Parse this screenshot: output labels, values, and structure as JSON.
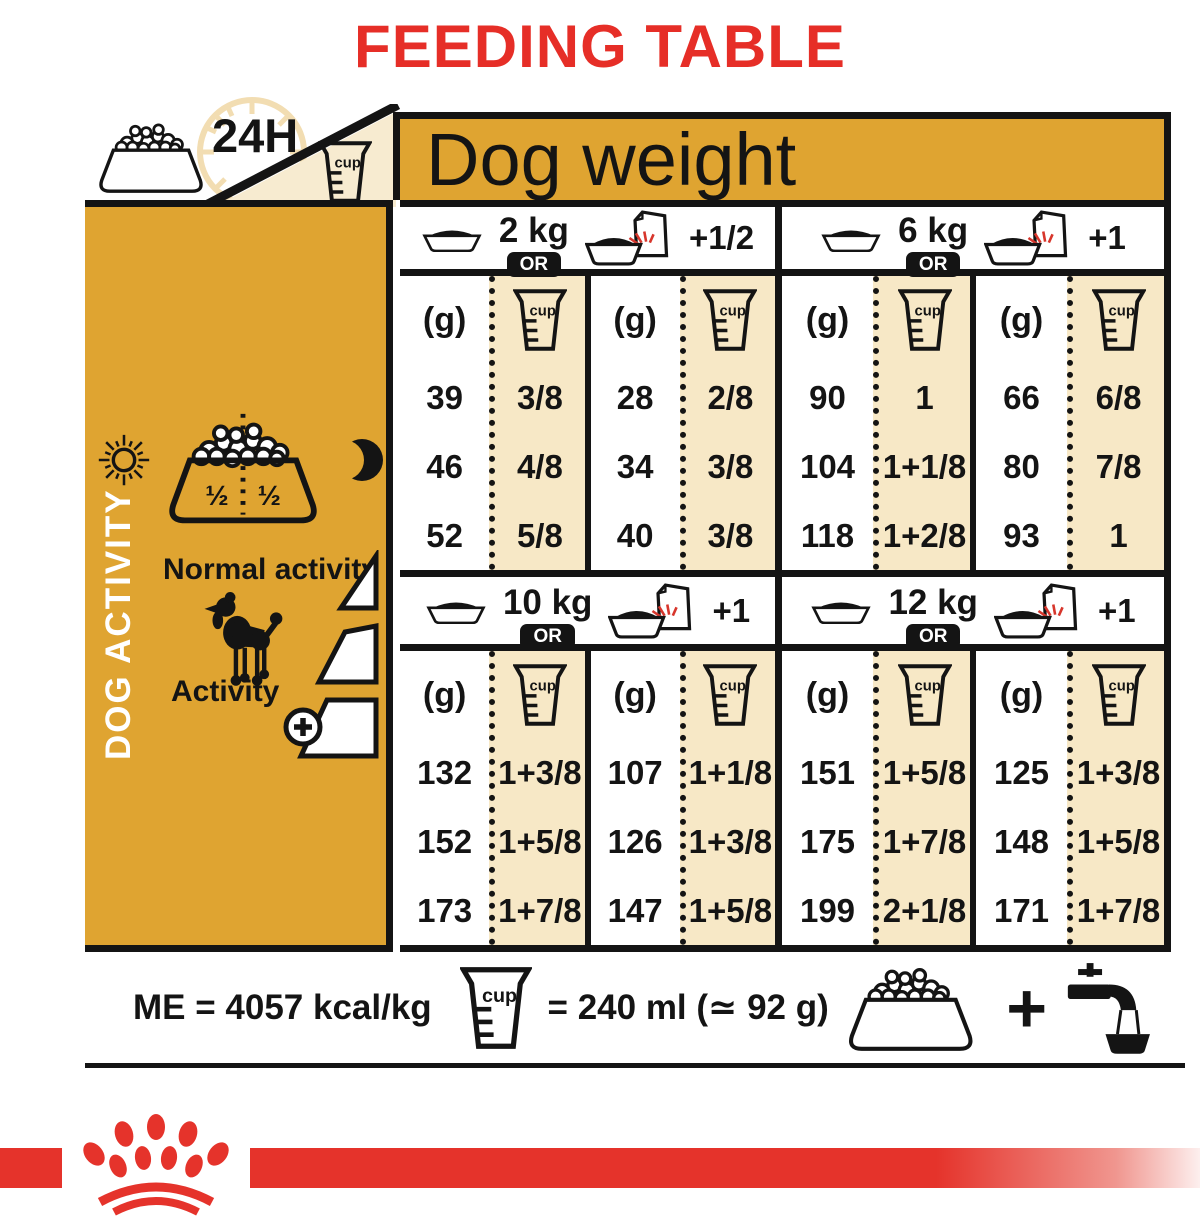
{
  "title": "FEEDING TABLE",
  "colors": {
    "red": "#e62e27",
    "gold": "#dfa431",
    "beige": "#f7e8c6",
    "ink": "#141414"
  },
  "corner": {
    "duration": "24H"
  },
  "dog_weight_header": "Dog weight",
  "labels": {
    "grams": "(g)",
    "cup": "cup",
    "or": "OR"
  },
  "sidebar": {
    "vertical_label": "DOG ACTIVITY",
    "bowl_half_left": "½",
    "bowl_half_right": "½",
    "normal_activity": "Normal activity",
    "activity": "Activity"
  },
  "groups": [
    {
      "weight": "2 kg",
      "extra": "+1/2",
      "cols": [
        {
          "g": [
            "39",
            "46",
            "52"
          ],
          "cup": [
            "3/8",
            "4/8",
            "5/8"
          ]
        },
        {
          "g": [
            "28",
            "34",
            "40"
          ],
          "cup": [
            "2/8",
            "3/8",
            "3/8"
          ]
        }
      ]
    },
    {
      "weight": "6 kg",
      "extra": "+1",
      "cols": [
        {
          "g": [
            "90",
            "104",
            "118"
          ],
          "cup": [
            "1",
            "1+1/8",
            "1+2/8"
          ]
        },
        {
          "g": [
            "66",
            "80",
            "93"
          ],
          "cup": [
            "6/8",
            "7/8",
            "1"
          ]
        }
      ]
    },
    {
      "weight": "10 kg",
      "extra": "+1",
      "cols": [
        {
          "g": [
            "132",
            "152",
            "173"
          ],
          "cup": [
            "1+3/8",
            "1+5/8",
            "1+7/8"
          ]
        },
        {
          "g": [
            "107",
            "126",
            "147"
          ],
          "cup": [
            "1+1/8",
            "1+3/8",
            "1+5/8"
          ]
        }
      ]
    },
    {
      "weight": "12 kg",
      "extra": "+1",
      "cols": [
        {
          "g": [
            "151",
            "175",
            "199"
          ],
          "cup": [
            "1+5/8",
            "1+7/8",
            "2+1/8"
          ]
        },
        {
          "g": [
            "125",
            "148",
            "171"
          ],
          "cup": [
            "1+3/8",
            "1+5/8",
            "1+7/8"
          ]
        }
      ]
    }
  ],
  "footer": {
    "me": "ME = 4057 kcal/kg",
    "cup_equals": "= 240 ml (≃ 92 g)",
    "plus": "+"
  }
}
